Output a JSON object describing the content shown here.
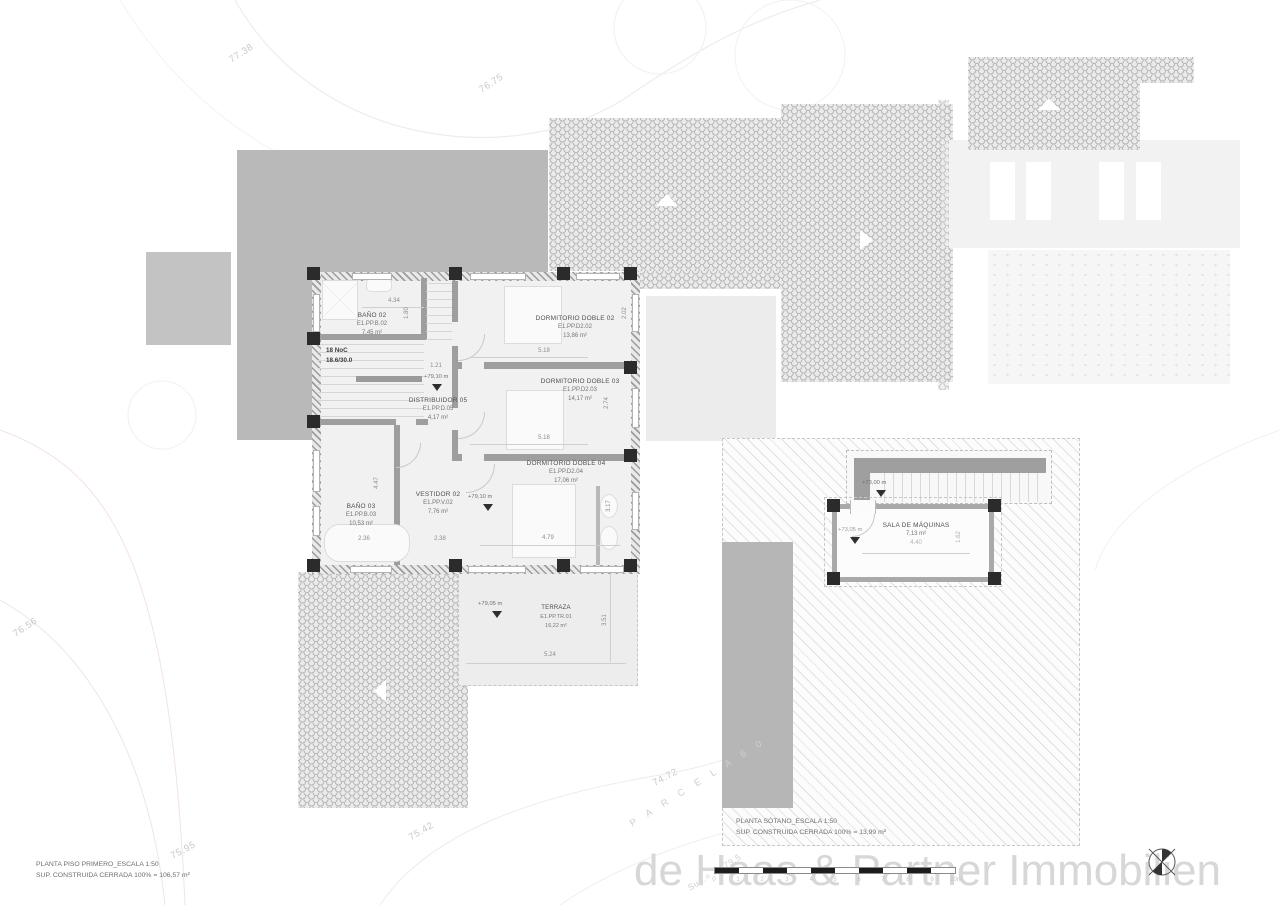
{
  "watermark": "de Haas & Partner Immobilien",
  "plans": {
    "first_floor": {
      "title": "PLANTA PISO PRIMERO_ESCALA 1:50",
      "area_line": "SUP. CONSTRUIDA CERRADA 100%  = 106,57 m²"
    },
    "basement": {
      "title": "PLANTA SÓTANO_ESCALA 1:50",
      "area_line": "SUP. CONSTRUIDA CERRADA 100%  = 13,99 m²"
    }
  },
  "contour_labels": {
    "c1": "77.38",
    "c2": "76.75",
    "c3": "76.56",
    "c4": "75.95",
    "c5": "75.42",
    "c6": "74.72"
  },
  "parcel": {
    "label": "P A R C E L A   6 0",
    "sup": "Sup.= 7.279,5"
  },
  "rooms": {
    "bano02": {
      "name": "BAÑO 02",
      "code": "E1.PP.B.02",
      "area": "7,45 m²"
    },
    "dorm02": {
      "name": "DORMITORIO DOBLE 02",
      "code": "E1.PP.D2.02",
      "area": "13,86 m²"
    },
    "dorm03": {
      "name": "DORMITORIO DOBLE 03",
      "code": "E1.PP.D2.03",
      "area": "14,17 m²"
    },
    "distribuidor": {
      "name": "DISTRIBUIDOR 05",
      "code": "E1.PP.D.05",
      "area": "4,17 m²"
    },
    "bano03": {
      "name": "BAÑO 03",
      "code": "E1.PP.B.03",
      "area": "10,53 m²"
    },
    "vestidor": {
      "name": "VESTIDOR 02",
      "code": "E1.PP.V.02",
      "area": "7,76 m²"
    },
    "dorm04": {
      "name": "DORMITORIO DOBLE 04",
      "code": "E1.PP.D2.04",
      "area": "17,06 m²"
    },
    "terraza": {
      "name": "TERRAZA",
      "code": "E1.PP.TR.01",
      "area": "16,22 m²"
    },
    "sala": {
      "name": "SALA DE MÁQUINAS",
      "area": "7,13 m²"
    }
  },
  "stair": {
    "line1": "18 NoC",
    "line2": "18.6/30.0"
  },
  "levels": {
    "l7910": "+79,10 m",
    "l7905": "+79,05 m",
    "l7300": "+73,00 m",
    "l7305": "+73,05 m"
  },
  "dims": {
    "d434": "4.34",
    "d180": "1.80",
    "d121": "1.21",
    "d518a": "5.18",
    "d518b": "5.18",
    "d274": "2.74",
    "d202": "2.02",
    "d236": "2.36",
    "d238": "2.38",
    "d479": "4.79",
    "d317": "3.17",
    "d447": "4.47",
    "d524": "5.24",
    "d351": "3.51",
    "d440": "4.40",
    "d162": "1.62"
  },
  "scalebar": {
    "ticks": [
      "0",
      "1",
      "2",
      "3",
      "4",
      "5",
      "6",
      "7",
      "8",
      "9",
      "10m"
    ]
  }
}
